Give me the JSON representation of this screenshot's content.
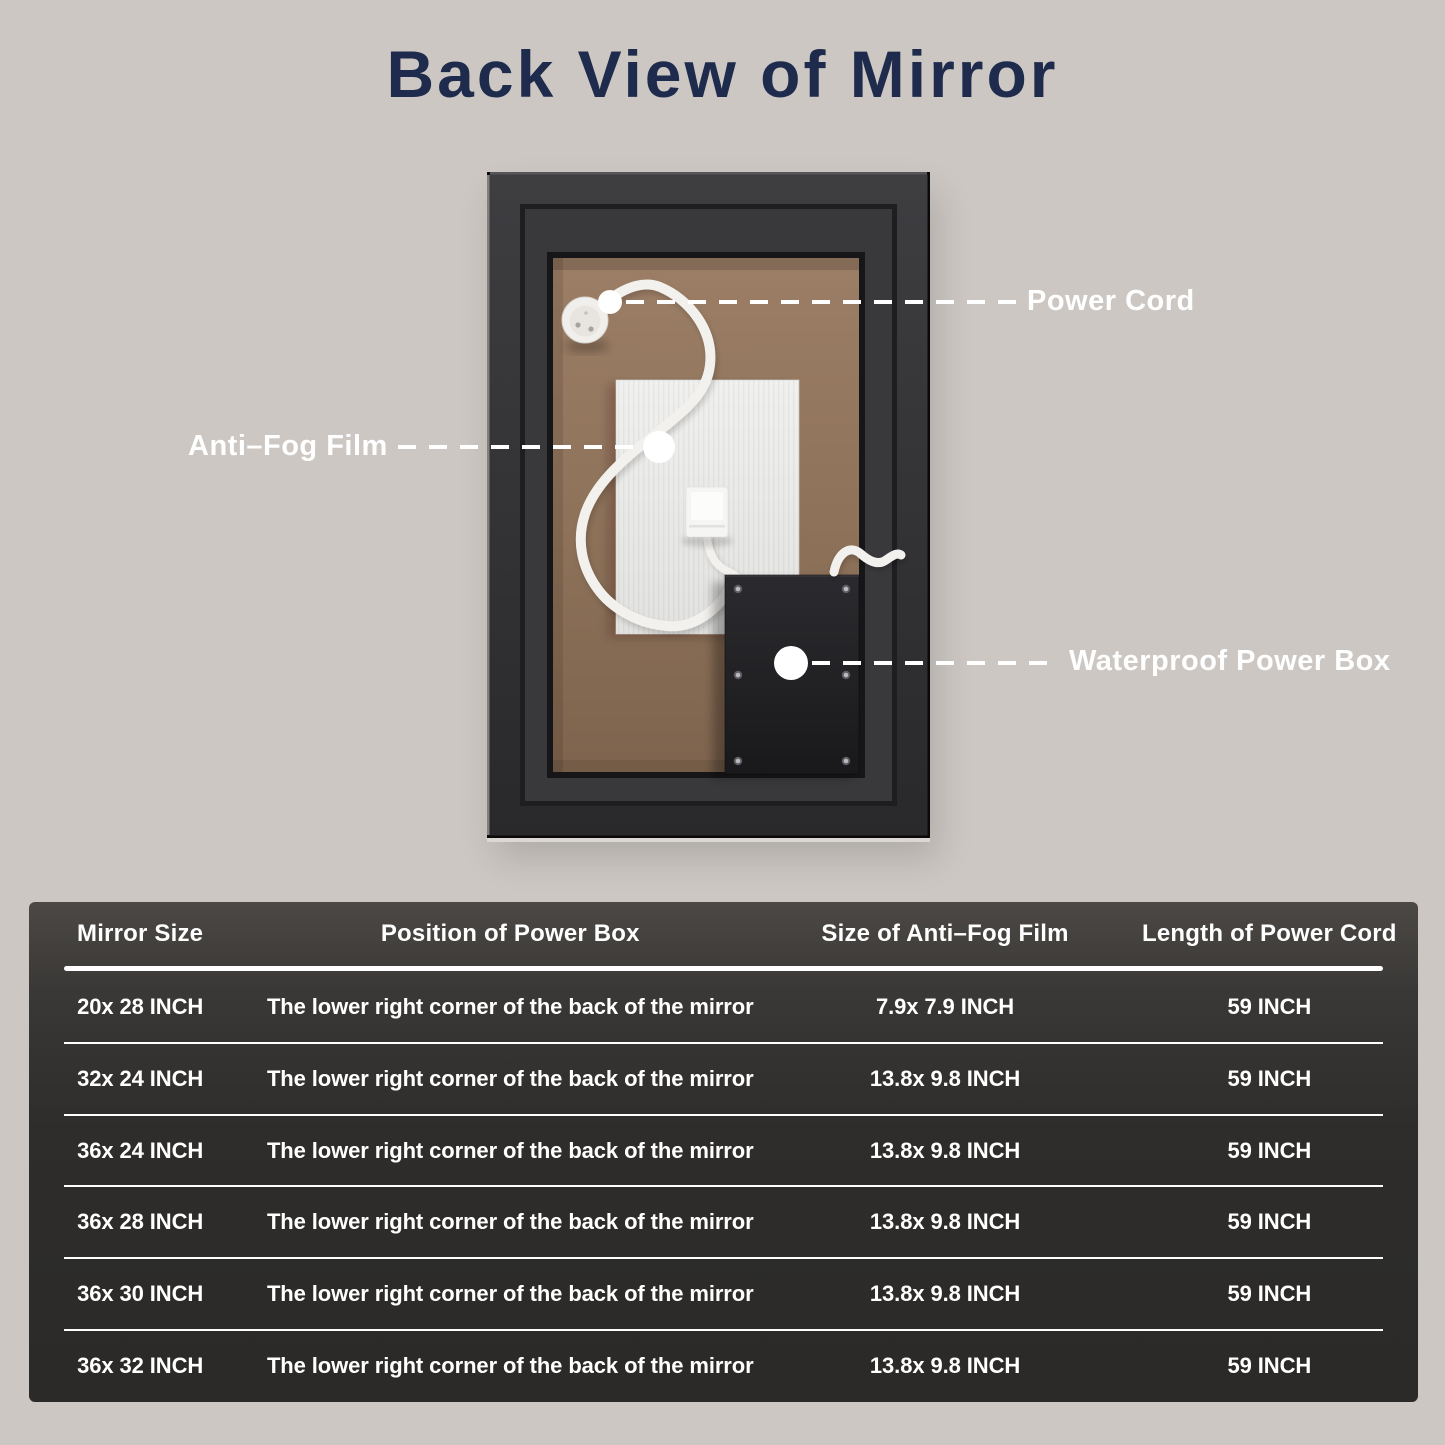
{
  "page": {
    "title": "Back View of Mirror",
    "background_color": "#ccc7c3",
    "title_color": "#1e2b4c"
  },
  "diagram": {
    "label_color": "#ffffff",
    "labels": {
      "power_cord": "Power Cord",
      "anti_fog_film": "Anti–Fog Film",
      "waterproof_power_box": "Waterproof Power Box"
    },
    "parts": {
      "frame_color": "#2e2e30",
      "backing_color": "#8f735c",
      "film_color": "#ececec",
      "power_box_color": "#1f1f22",
      "cord_color": "#f3f1ee"
    }
  },
  "spec_table": {
    "background_top": "#4b4845",
    "background_bottom": "#2b2a28",
    "text_color": "#ffffff",
    "columns": [
      "Mirror Size",
      "Position of Power Box",
      "Size of Anti–Fog Film",
      "Length of Power Cord"
    ],
    "rows": [
      [
        "20x 28 INCH",
        "The lower right corner of the back of the mirror",
        "7.9x 7.9 INCH",
        "59 INCH"
      ],
      [
        "32x 24 INCH",
        "The lower right corner of the back of the mirror",
        "13.8x 9.8 INCH",
        "59 INCH"
      ],
      [
        "36x 24 INCH",
        "The lower right corner of the back of the mirror",
        "13.8x 9.8 INCH",
        "59 INCH"
      ],
      [
        "36x 28 INCH",
        "The lower right corner of the back of the mirror",
        "13.8x 9.8 INCH",
        "59 INCH"
      ],
      [
        "36x 30 INCH",
        "The lower right corner of the back of the mirror",
        "13.8x 9.8 INCH",
        "59 INCH"
      ],
      [
        "36x 32 INCH",
        "The lower right corner of the back of the mirror",
        "13.8x 9.8 INCH",
        "59 INCH"
      ]
    ]
  }
}
